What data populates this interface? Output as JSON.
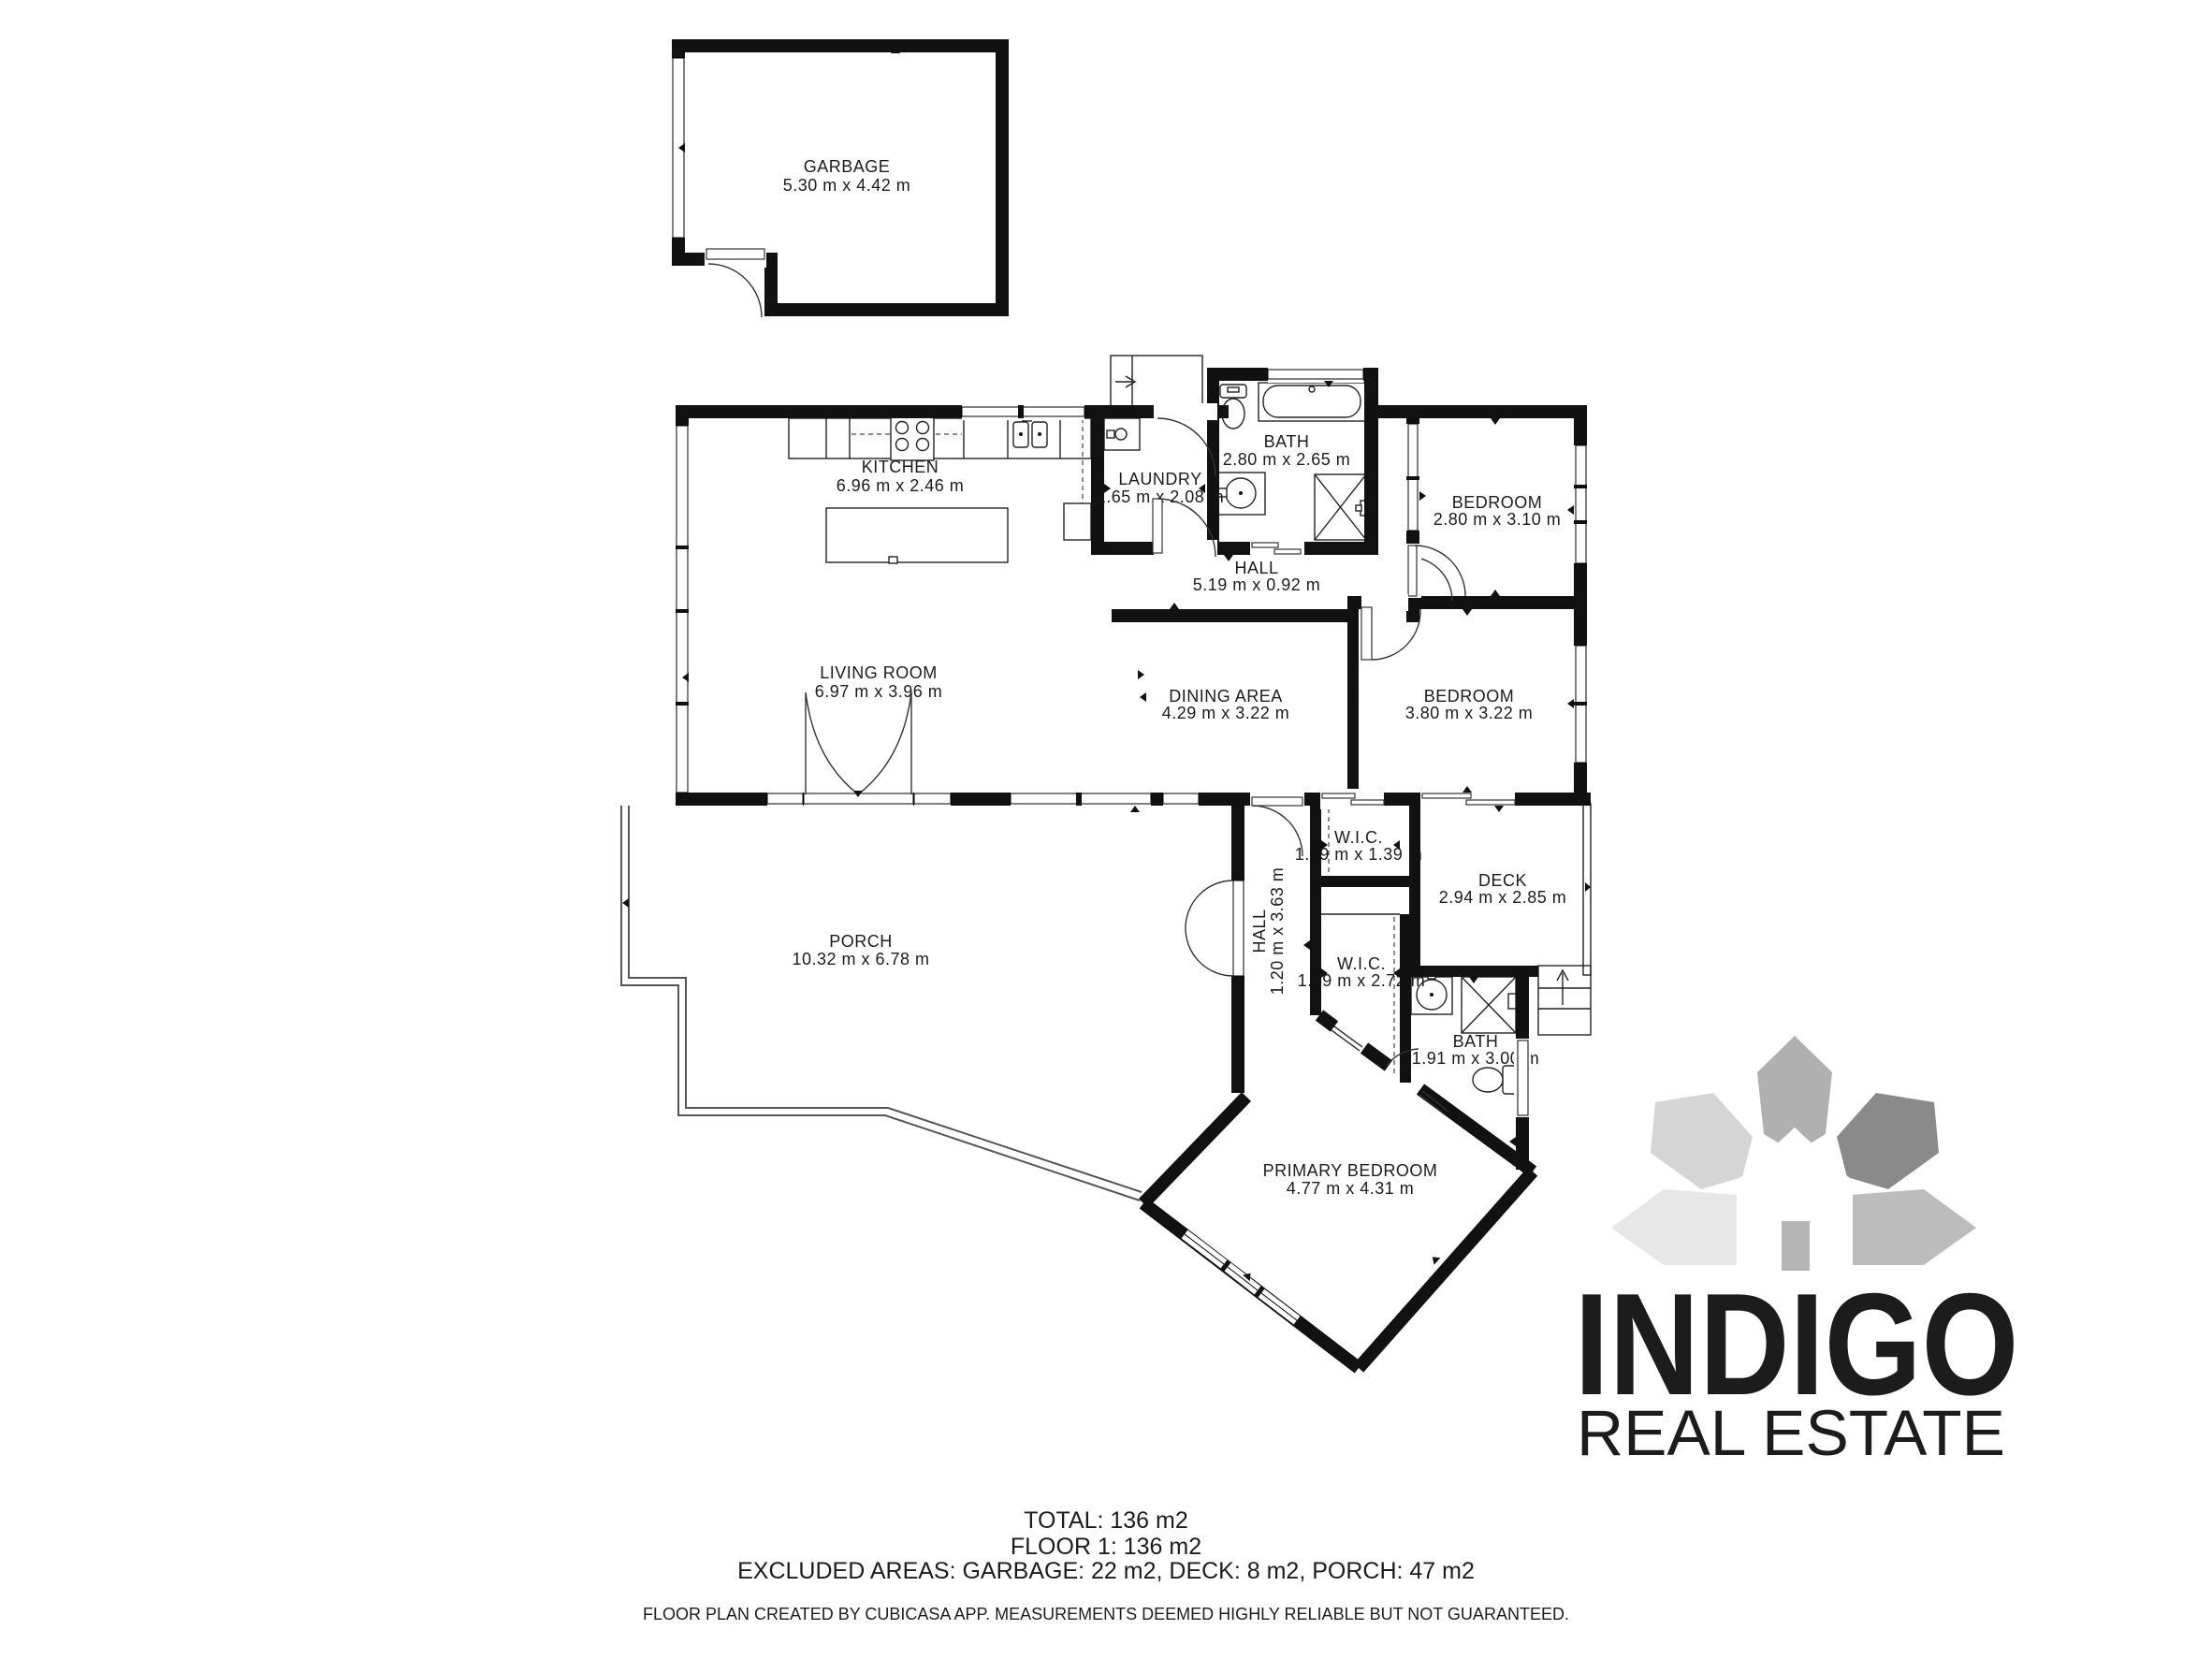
{
  "rooms": [
    {
      "id": "garbage",
      "name": "GARBAGE",
      "dims": "5.30 m x 4.42 m"
    },
    {
      "id": "kitchen",
      "name": "KITCHEN",
      "dims": "6.96 m x 2.46 m"
    },
    {
      "id": "laundry",
      "name": "LAUNDRY",
      "dims": "1.65 m x 2.08 m"
    },
    {
      "id": "bath1",
      "name": "BATH",
      "dims": "2.80 m x 2.65 m"
    },
    {
      "id": "bedroom1",
      "name": "BEDROOM",
      "dims": "2.80 m x 3.10 m"
    },
    {
      "id": "hall1",
      "name": "HALL",
      "dims": "5.19 m x 0.92 m"
    },
    {
      "id": "living",
      "name": "LIVING ROOM",
      "dims": "6.97 m x 3.96 m"
    },
    {
      "id": "dining",
      "name": "DINING AREA",
      "dims": "4.29 m x 3.22 m"
    },
    {
      "id": "bedroom2",
      "name": "BEDROOM",
      "dims": "3.80 m x 3.22 m"
    },
    {
      "id": "wic1",
      "name": "W.I.C.",
      "dims": "1.49 m x 1.39 m"
    },
    {
      "id": "deck",
      "name": "DECK",
      "dims": "2.94 m x 2.85 m"
    },
    {
      "id": "wic2",
      "name": "W.I.C.",
      "dims": "1.49 m x 2.72 m"
    },
    {
      "id": "hall2",
      "name": "HALL",
      "dims": "1.20 m x 3.63 m"
    },
    {
      "id": "bath2",
      "name": "BATH",
      "dims": "1.91 m x 3.00 m"
    },
    {
      "id": "primary",
      "name": "PRIMARY BEDROOM",
      "dims": "4.77 m x 4.31 m"
    },
    {
      "id": "porch",
      "name": "PORCH",
      "dims": "10.32 m x 6.78 m"
    }
  ],
  "summary": {
    "total": "TOTAL: 136 m2",
    "floor": "FLOOR 1: 136 m2",
    "excluded": "EXCLUDED AREAS: GARBAGE: 22 m2, DECK: 8 m2, PORCH: 47 m2",
    "disclaimer": "FLOOR PLAN CREATED BY CUBICASA APP. MEASUREMENTS DEEMED HIGHLY RELIABLE BUT NOT GUARANTEED."
  },
  "logo": {
    "name": "INDIGO",
    "tagline": "REAL ESTATE"
  },
  "colors": {
    "wall": "#111111",
    "logo_name": "#8f8f8f",
    "logo_tagline": "#9b9b9b",
    "petal_light": "#e7e7e7",
    "petal_dark": "#8a8a8a"
  }
}
